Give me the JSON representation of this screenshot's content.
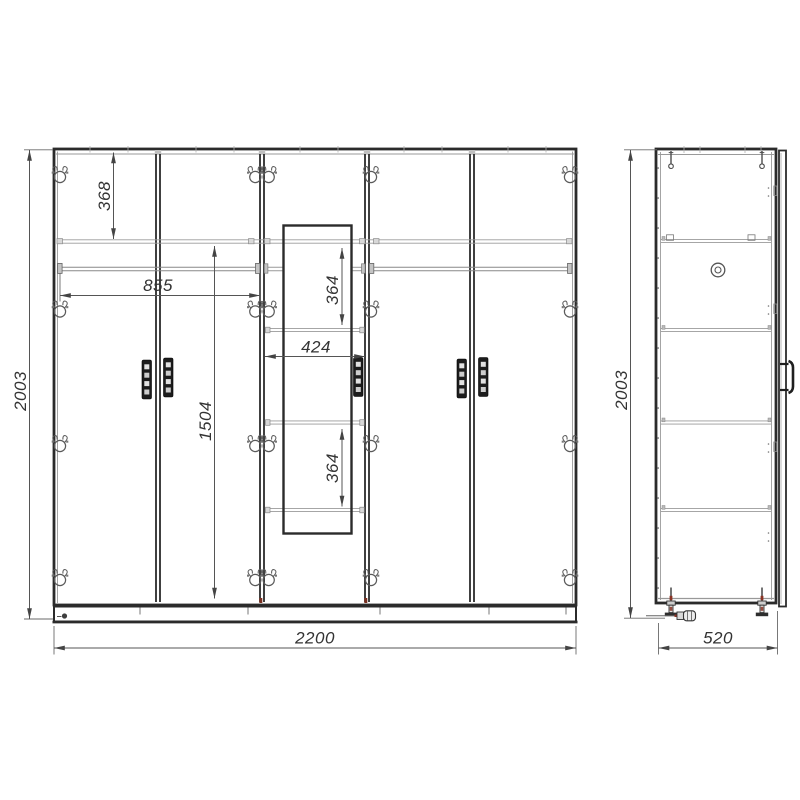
{
  "views": {
    "front": {
      "dims": {
        "height": "2003",
        "width": "2200",
        "top_section": "368",
        "rod_width": "855",
        "interior_height": "1504",
        "center_upper": "364",
        "center_width": "424",
        "center_lower": "364"
      }
    },
    "side": {
      "dims": {
        "height": "2003",
        "depth": "520"
      }
    }
  },
  "colors": {
    "line": "#2b2b2b",
    "thin_line": "#9a9a9a",
    "dim_line": "#555555",
    "dim_text": "#333333",
    "shelf_cap": "#d8d8d8",
    "accent_red": "#8a3324",
    "background": "#ffffff"
  }
}
